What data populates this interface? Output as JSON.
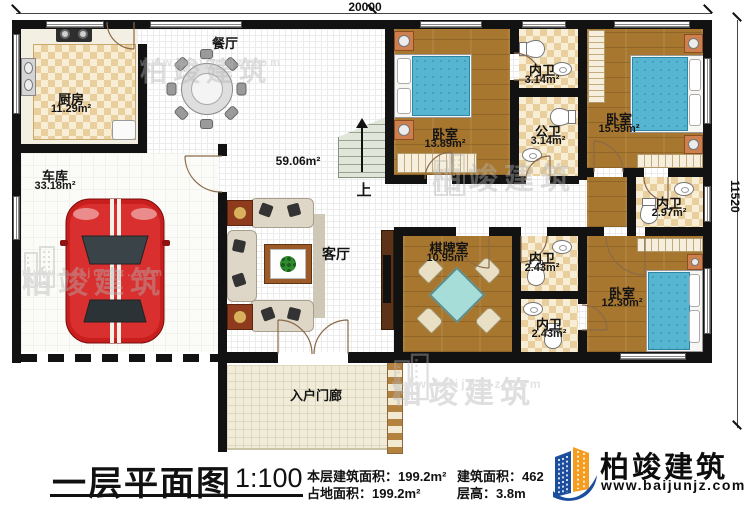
{
  "dimensions": {
    "width_label": "20000",
    "height_label": "11520"
  },
  "rooms": {
    "kitchen": {
      "label": "厨房",
      "area": "11.29m²"
    },
    "dining": {
      "label": "餐厅"
    },
    "garage": {
      "label": "车库",
      "area": "33.18m²"
    },
    "living": {
      "label": "客厅",
      "area": "59.06m²"
    },
    "stairs": {
      "label": "上"
    },
    "bedroom1": {
      "label": "卧室",
      "area": "13.89m²"
    },
    "ensuite1": {
      "label": "内卫",
      "area": "3.14m²"
    },
    "public_bath": {
      "label": "公卫",
      "area": "3.14m²"
    },
    "bedroom2": {
      "label": "卧室",
      "area": "15.59m²"
    },
    "ensuite2": {
      "label": "内卫",
      "area": "2.97m²"
    },
    "mahjong_room": {
      "label": "棋牌室",
      "area": "10.95m²"
    },
    "ensuite3": {
      "label": "内卫",
      "area": "2.43m²"
    },
    "ensuite4": {
      "label": "内卫",
      "area": "2.43m²"
    },
    "bedroom3": {
      "label": "卧室",
      "area": "12.30m²"
    },
    "porch": {
      "label": "入户门廊"
    }
  },
  "title_block": {
    "title": "一层平面图",
    "scale": "1:100",
    "floor_area": "本层建筑面积：199.2m²",
    "land_area": "占地面积：199.2m²",
    "gross_area": "建筑面积：462",
    "story_height": "层高：3.8m"
  },
  "logo": {
    "name": "柏竣建筑",
    "website": "www.baijunjz.com"
  },
  "watermark": {
    "name": "柏竣建筑",
    "website": "www.baijunjz.com"
  },
  "colors": {
    "wall": "#121212",
    "wood_floor": "#a8772f",
    "tile_checker": "#e9cf9d",
    "bed_blue": "#56b6d1",
    "car_red": "#c81e1e",
    "logo_blue": "#1b4f9e",
    "logo_orange": "#f59d20"
  }
}
